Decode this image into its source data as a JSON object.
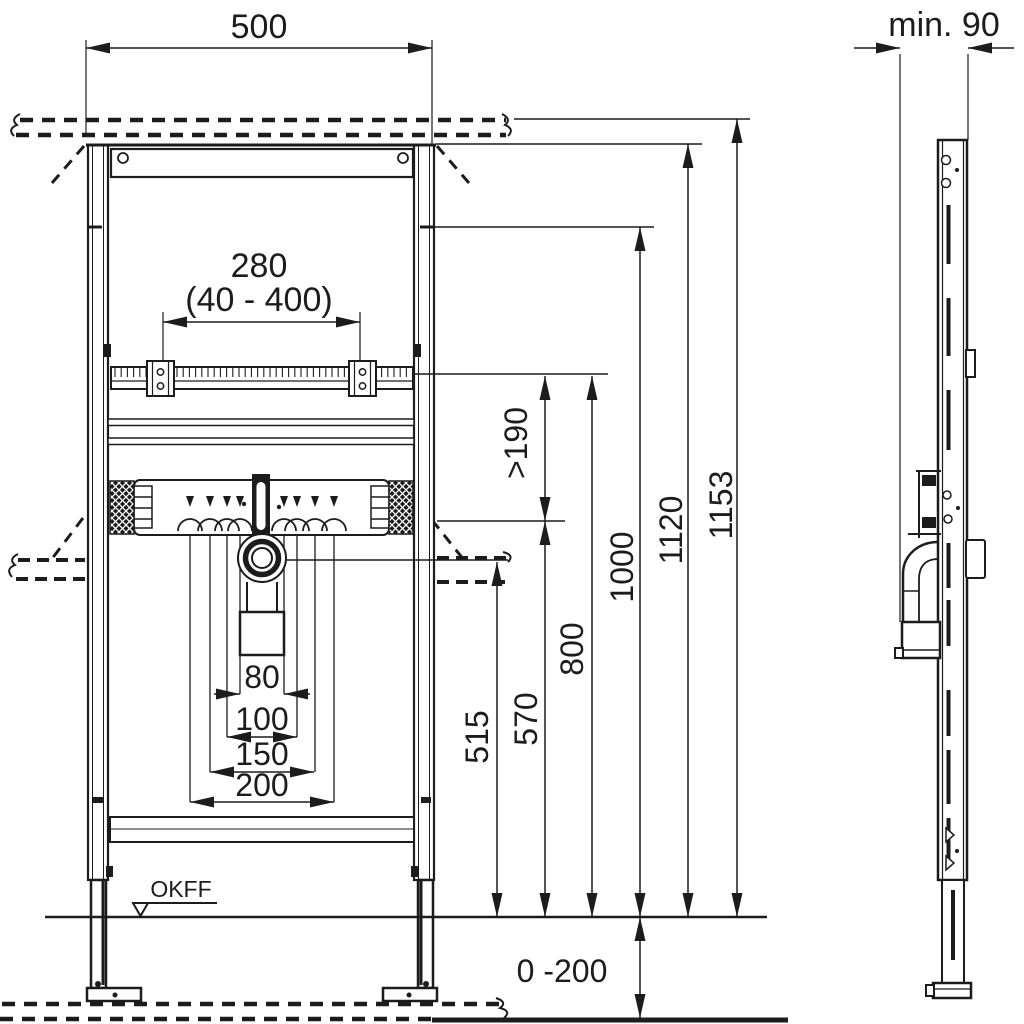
{
  "drawing": {
    "floor_label": "OKFF",
    "front": {
      "width": "500",
      "tap_center": "280",
      "tap_range": "(40 - 400)",
      "clearance": ">190",
      "drain_height": "515",
      "manifold_height": "570",
      "rail_height": "800",
      "upper_fix_height": "1000",
      "frame_top_height": "1120",
      "total_height": "1153",
      "offset_80": "80",
      "offset_100": "100",
      "offset_150": "150",
      "offset_200": "200",
      "floor_adjust": "0 -200"
    },
    "side": {
      "min_depth": "min. 90"
    },
    "colors": {
      "line": "#1c1c1c",
      "background": "#ffffff"
    }
  }
}
